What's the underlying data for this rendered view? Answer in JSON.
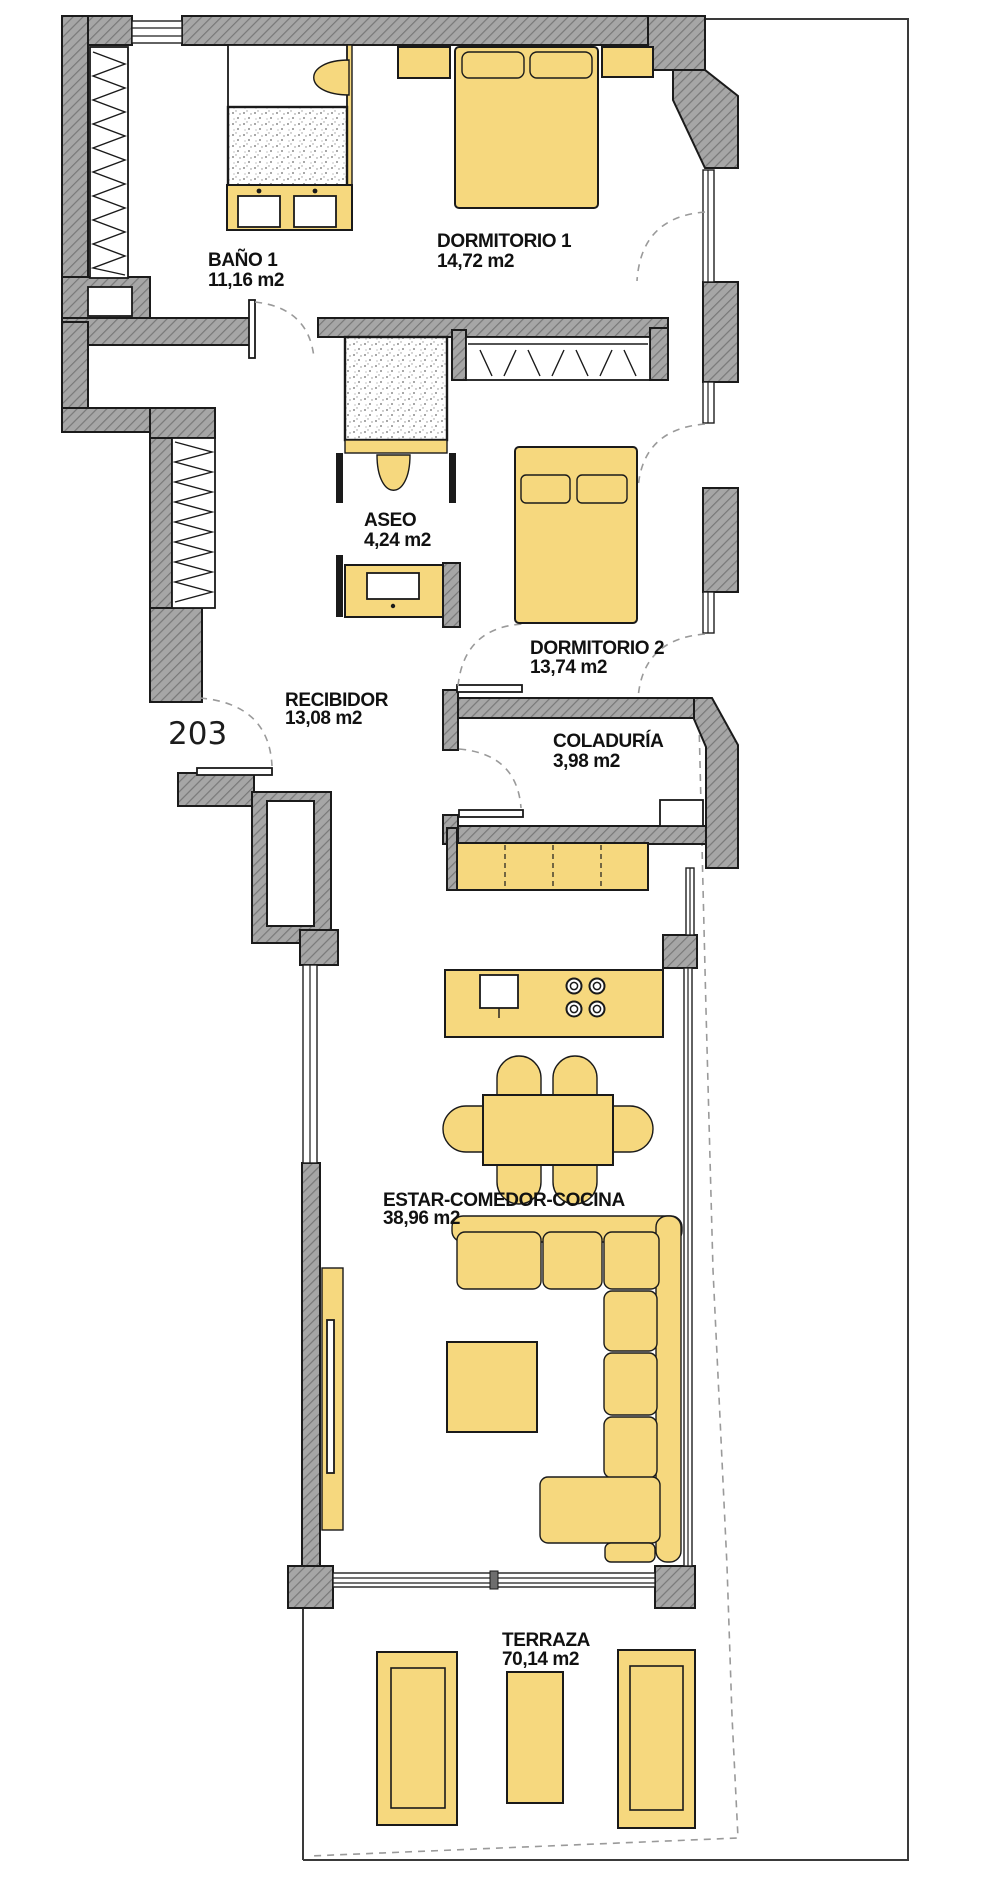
{
  "plan": {
    "unit_number": "203",
    "rooms": [
      {
        "id": "bano-1",
        "name": "BAÑO 1",
        "area": "11,16 m2"
      },
      {
        "id": "dormitorio-1",
        "name": "DORMITORIO 1",
        "area": "14,72 m2"
      },
      {
        "id": "aseo",
        "name": "ASEO",
        "area": "4,24 m2"
      },
      {
        "id": "dormitorio-2",
        "name": "DORMITORIO 2",
        "area": "13,74 m2"
      },
      {
        "id": "recibidor",
        "name": "RECIBIDOR",
        "area": "13,08 m2"
      },
      {
        "id": "coladuria",
        "name": "COLADURÍA",
        "area": "3,98 m2"
      },
      {
        "id": "estar-comedor-cocina",
        "name": "ESTAR-COMEDOR-COCINA",
        "area": "38,96 m2"
      },
      {
        "id": "terraza",
        "name": "TERRAZA",
        "area": "70,14 m2"
      }
    ],
    "colors": {
      "furniture": "#F6D87E",
      "wall_fill": "#A6A6A6",
      "wall_hatch": "#787878",
      "outline": "#1B1B1B",
      "door_swing_dash": "#9A9A9A"
    }
  }
}
